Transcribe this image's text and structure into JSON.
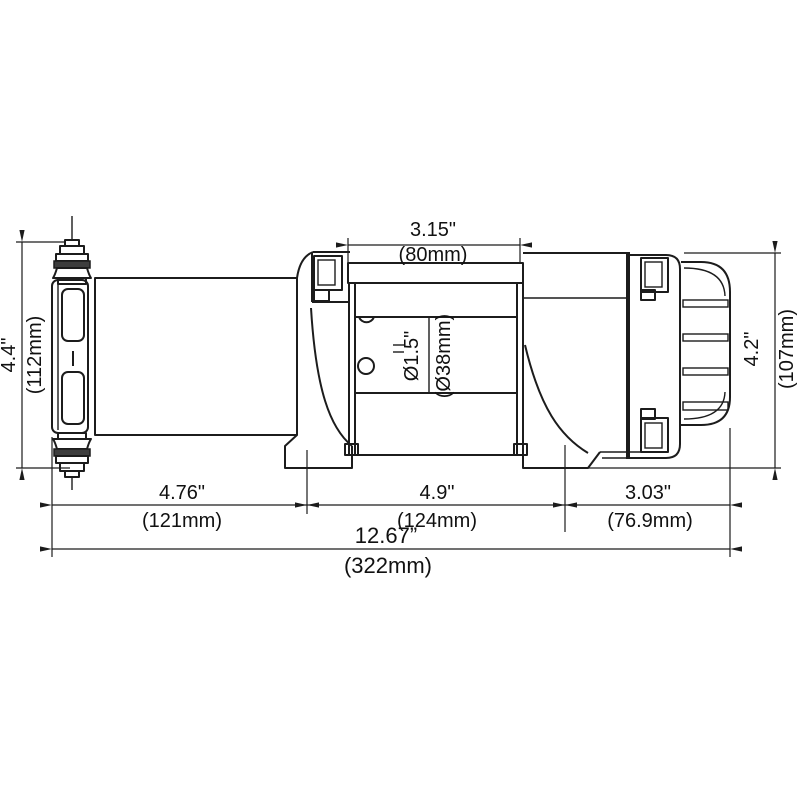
{
  "drawing": {
    "subject": "winch-side-view-technical-drawing",
    "colors": {
      "line": "#1c1c1c",
      "background": "#ffffff",
      "washer_fill": "#3d3d3d"
    }
  },
  "dimensions": {
    "drum_width": {
      "inches": "3.15\"",
      "mm": "(80mm)"
    },
    "plate_height": {
      "inches": "4.4\"",
      "mm": "(112mm)"
    },
    "drum_diameter": {
      "inches": "Ø1.5\"",
      "mm": "(Ø38mm)"
    },
    "motor_height": {
      "inches": "4.2\"",
      "mm": "(107mm)"
    },
    "gearbox_length": {
      "inches": "4.76\"",
      "mm": "(121mm)"
    },
    "drum_section_length": {
      "inches": "4.9\"",
      "mm": "(124mm)"
    },
    "motor_length": {
      "inches": "3.03\"",
      "mm": "(76.9mm)"
    },
    "overall_length": {
      "inches": "12.67”",
      "mm": "(322mm)"
    }
  }
}
